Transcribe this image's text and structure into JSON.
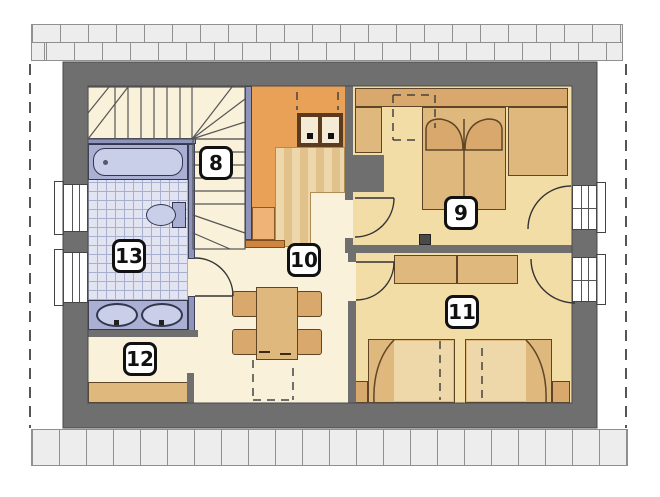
{
  "plan": {
    "kind": "attic-floor-plan",
    "labels": {
      "room8": "8",
      "room9": "9",
      "room10": "10",
      "room11": "11",
      "room12": "12",
      "room13": "13"
    },
    "fixtures": [
      "staircase",
      "void-balustrade",
      "chimney",
      "bathtub",
      "toilet",
      "double-washbasin",
      "double-bed",
      "wardrobe",
      "sofa",
      "single-bed",
      "single-bed",
      "nightstand",
      "dining-table",
      "chair",
      "counter"
    ]
  },
  "colors": {
    "wall": "#6f6f6f",
    "floor_hall": "#f9f1da",
    "floor_room": "#f2dda6",
    "void_orange": "#e9a158",
    "void_orange_light": "#f0b377",
    "railing_orange": "#cf8440",
    "bath_fixture": "#aab0d4",
    "bath_fixture_light": "#c9cee9",
    "tile_floor": "#e2e5f1",
    "tile_grid": "#a9b0cf",
    "furniture": "#dfb87e",
    "furniture_light": "#eed7a8",
    "furniture_mid": "#d8a86c",
    "outline": "#5f4526",
    "stripe_light": "#eed8ab",
    "stripe_dark": "#e2c28b",
    "band_fill": "#ededed",
    "band_line": "#909090",
    "balustrade": "#8e94ba",
    "label_border": "#111111"
  }
}
